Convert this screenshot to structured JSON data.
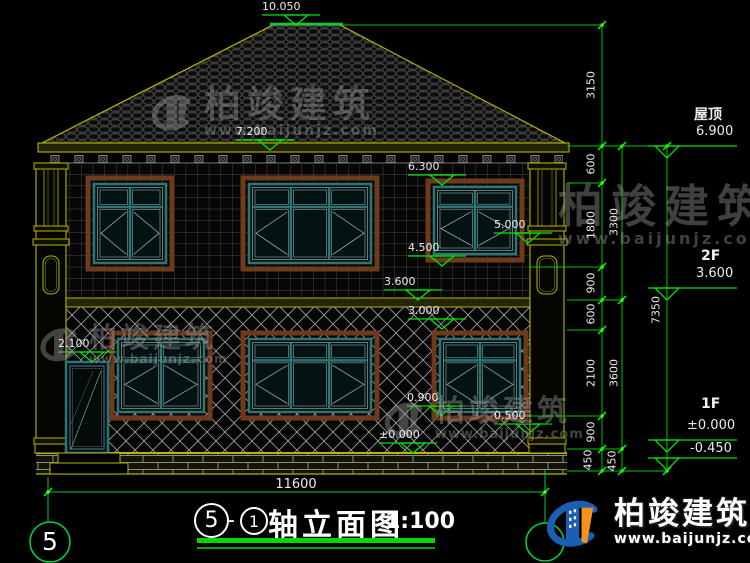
{
  "title": {
    "left_axis": "5",
    "separator": "-",
    "right_axis": "1",
    "name": "轴立面图",
    "scale": "1:100"
  },
  "axis": {
    "bottom_left": "5"
  },
  "markers_building": [
    {
      "label": "10.050"
    },
    {
      "label": "7.200"
    },
    {
      "label": "6.300"
    },
    {
      "label": "5.000"
    },
    {
      "label": "4.500"
    },
    {
      "label": "3.600"
    },
    {
      "label": "3.000"
    },
    {
      "label": "2.100"
    },
    {
      "label": "0.900"
    },
    {
      "label": "0.500"
    },
    {
      "label": "±0.000"
    }
  ],
  "markers_right": [
    {
      "name": "屋顶",
      "value": "6.900"
    },
    {
      "name": "2F",
      "value": "3.600"
    },
    {
      "name": "1F",
      "value": "±0.000"
    },
    {
      "name": "",
      "value": "-0.450"
    }
  ],
  "dimensions": {
    "right_inner": [
      "3150",
      "600",
      "1800",
      "900",
      "600",
      "2100",
      "900",
      "450"
    ],
    "right_middle": [
      "3300",
      "3600",
      "450"
    ],
    "right_outer": [
      "7350"
    ],
    "bottom_width": "11600"
  },
  "watermark": {
    "brand": "柏竣建筑",
    "url": "www.baijunjz.com"
  },
  "colors": {
    "dimension_green": "#00e400",
    "structure_yellow": "#b8b400",
    "window_teal": "#2d7474",
    "logo_blue": "#1b5fb4",
    "logo_orange": "#f6921e"
  }
}
